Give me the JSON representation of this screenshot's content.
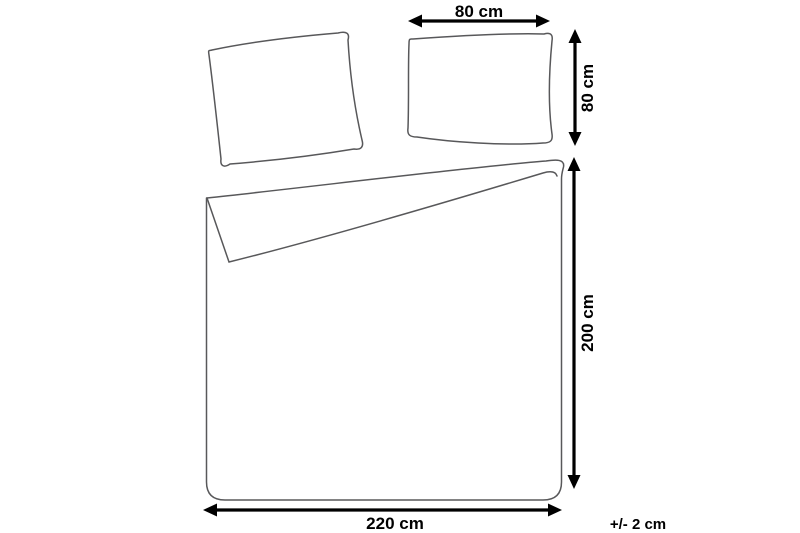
{
  "labels": {
    "pillow_width": "80 cm",
    "pillow_height": "80 cm",
    "duvet_height": "200 cm",
    "duvet_width": "220 cm",
    "tolerance": "+/- 2 cm"
  },
  "colors": {
    "background": "#ffffff",
    "outline": "#58585a",
    "dimension": "#000000"
  }
}
